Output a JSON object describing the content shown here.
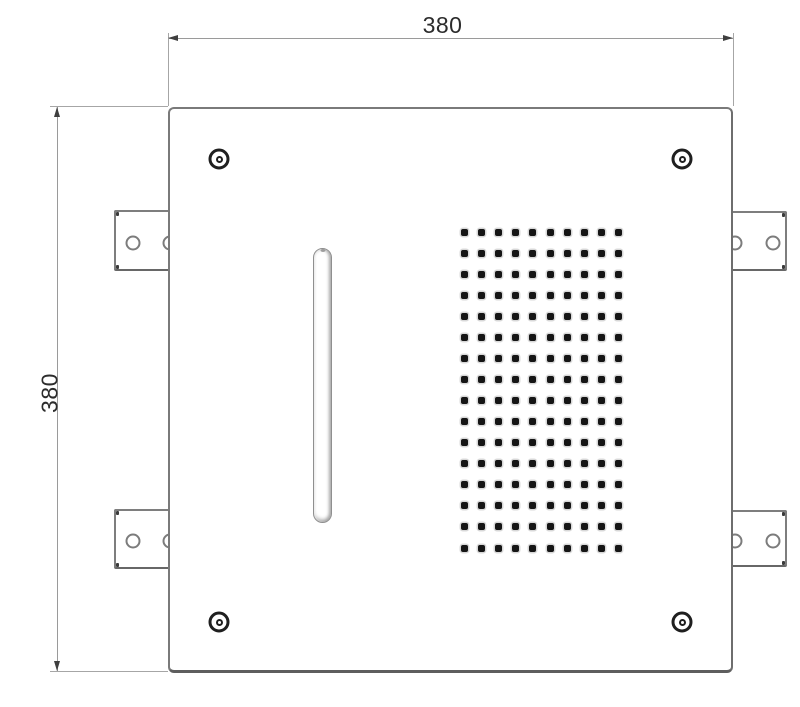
{
  "drawing": {
    "type": "technical-dimension-drawing",
    "subject": "square-ceiling-panel-front-view",
    "background_color": "#ffffff",
    "line_color": "#7a7a7a",
    "dim_line_color": "#9a9a9a",
    "text_color": "#2c2c2c",
    "dot_color": "#151515",
    "dim_top": {
      "label": "380"
    },
    "dim_left": {
      "label": "380"
    },
    "panel": {
      "x": 168,
      "y": 107,
      "w": 565,
      "h": 566
    },
    "screws": [
      {
        "cx": 219,
        "cy": 159
      },
      {
        "cx": 682,
        "cy": 159
      },
      {
        "cx": 219,
        "cy": 622
      },
      {
        "cx": 682,
        "cy": 622
      }
    ],
    "slot": {
      "x": 313,
      "y": 248,
      "w": 19,
      "h": 275
    },
    "perforation_grid": {
      "cols": 10,
      "rows": 16,
      "x0": 464,
      "y0": 232,
      "dx": 17.2,
      "dy": 21.07,
      "dot_size": 7
    },
    "brackets": [
      {
        "side": "left",
        "x": 114,
        "y": 210,
        "w": 54,
        "h": 61
      },
      {
        "side": "left",
        "x": 114,
        "y": 509,
        "w": 54,
        "h": 60
      },
      {
        "side": "right",
        "x": 733,
        "y": 211,
        "w": 54,
        "h": 60
      },
      {
        "side": "right",
        "x": 733,
        "y": 510,
        "w": 54,
        "h": 57
      }
    ]
  }
}
